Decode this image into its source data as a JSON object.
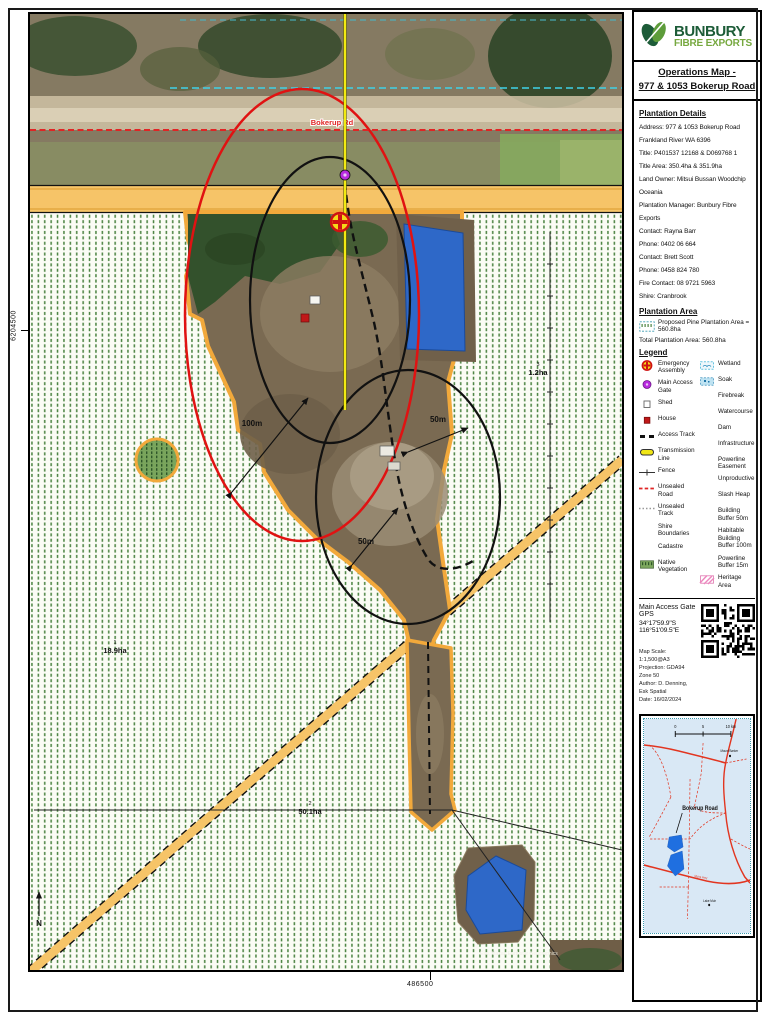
{
  "brand": {
    "name_top": "BUNBURY",
    "name_bottom": "FIBRE EXPORTS"
  },
  "title": {
    "line1": "Operations Map -",
    "line2": "977 & 1053 Bokerup Road"
  },
  "plantation_details": {
    "heading": "Plantation Details",
    "lines": [
      "Address: 977 &  1053 Bokerup Road",
      "Frankland River WA 6396",
      "Title:  P401537 12168 & D069768 1",
      "Title Area:  350.4ha & 351.9ha",
      "Land Owner: Mitsui Bussan Woodchip",
      "Oceania",
      "Plantation Manager: Bunbury Fibre Exports",
      "Contact: Rayna Barr",
      "Phone: 0402 06 664",
      "Contact: Brett Scott",
      "Phone: 0458 824 780",
      "Fire Contact: 08 9721 5963",
      "Shire:  Cranbrook"
    ]
  },
  "plantation_area": {
    "heading": "Plantation Area",
    "proposed": "Proposed Pine Plantation Area = 560.8ha",
    "total": "Total Plantation Area: 560.8ha"
  },
  "legend": {
    "heading": "Legend",
    "left": [
      {
        "icon": "emergency-assembly-icon",
        "label": "Emergency Assembly"
      },
      {
        "icon": "main-access-gate-icon",
        "label": "Main Access Gate"
      },
      {
        "icon": "shed-icon",
        "label": "Shed"
      },
      {
        "icon": "house-icon",
        "label": "House"
      },
      {
        "icon": "access-track-icon",
        "label": "Access Track"
      },
      {
        "icon": "transmission-line-icon",
        "label": "Transmission Line"
      },
      {
        "icon": "fence-icon",
        "label": "Fence"
      },
      {
        "icon": "unsealed-road-icon",
        "label": "Unsealed Road"
      },
      {
        "icon": "unsealed-track-icon",
        "label": "Unsealed Track"
      },
      {
        "icon": "shire-boundaries-icon",
        "label": "Shire Boundaries"
      },
      {
        "icon": "cadastre-icon",
        "label": "Cadastre"
      },
      {
        "icon": "native-vegetation-icon",
        "label": "Native Vegetation"
      }
    ],
    "right": [
      {
        "icon": "wetland-icon",
        "label": "Wetland"
      },
      {
        "icon": "soak-icon",
        "label": "Soak"
      },
      {
        "icon": "firebreak-icon",
        "label": "Firebreak"
      },
      {
        "icon": "watercourse-icon",
        "label": "Watercourse"
      },
      {
        "icon": "dam-icon",
        "label": "Dam"
      },
      {
        "icon": "infrastructure-icon",
        "label": "Infrastructure"
      },
      {
        "icon": "powerline-easement-icon",
        "label": "Powerline Easement"
      },
      {
        "icon": "unproductive-icon",
        "label": "Unproductive"
      },
      {
        "icon": "slash-heap-icon",
        "label": "Slash Heap"
      },
      {
        "icon": "building-buffer-icon",
        "label": "Building Buffer 50m"
      },
      {
        "icon": "habitable-building-buffer-icon",
        "label": "Habitable Building Buffer 100m"
      },
      {
        "icon": "powerline-buffer-icon",
        "label": "Powerline Buffer 15m"
      },
      {
        "icon": "heritage-area-icon",
        "label": "Heritage Area"
      }
    ]
  },
  "gps": {
    "label": "Main Access Gate GPS",
    "coords": "34°17'59.9\"S 116°51'09.5\"E"
  },
  "meta": {
    "lines": [
      "Map Scale: 1:1,500@A3",
      "Projection: GDA94 Zone 50",
      "Author: D. Denning, Esk Spatial",
      "Date: 16/02/2024"
    ]
  },
  "map": {
    "road_label": "Bokerup Rd",
    "buffer_100_label": "100m",
    "buffer_50_label": "50m",
    "parcels": [
      {
        "id": "1",
        "area": "18.9ha"
      },
      {
        "id": "2",
        "area": "50.1ha"
      },
      {
        "id": "3",
        "area": "1.2ha"
      }
    ],
    "coord_left": "6204500",
    "coord_bottom": "486500",
    "north_label": "N",
    "attribution": "Esri, Maxar, Earthstar Geographics"
  },
  "inset": {
    "scale_ticks": [
      "0",
      "5",
      "10 km"
    ],
    "road_label": "Bokerup Road",
    "highway_label": "Muirs Hwy",
    "towns": [
      "Mount Barker",
      "Lake Muir"
    ]
  },
  "colors": {
    "brand_green": "#1d5c38",
    "brand_light_green": "#76a83f",
    "firebreak_orange": "#f2a93b",
    "dam_blue": "#2e68c8",
    "buffer_red": "#e01212",
    "gate_purple": "#b92be0",
    "unsealed_road_red": "#e02525",
    "transmission_yellow": "#f0e616"
  }
}
